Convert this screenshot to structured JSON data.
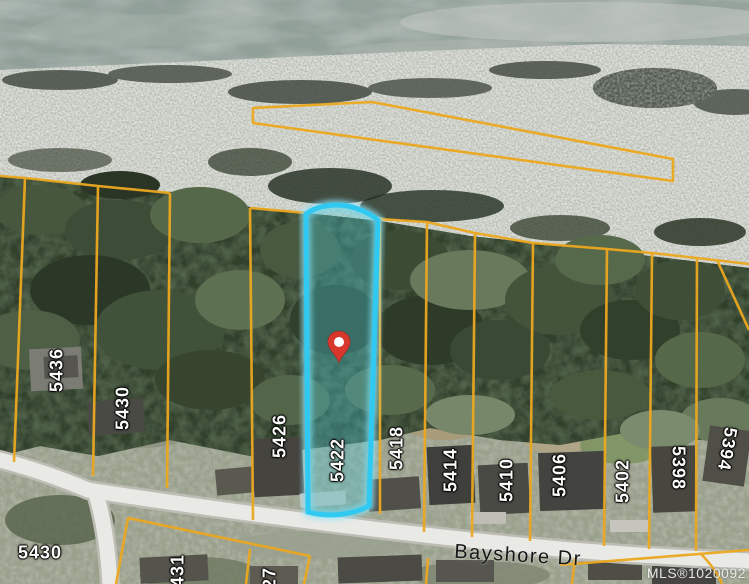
{
  "map": {
    "street": {
      "label": "Bayshore Dr"
    },
    "watermark": {
      "text": "MLS®1020092"
    },
    "highlighted_parcel": {
      "number": "5422",
      "border_color": "#2fc9f1",
      "fill_color": "rgba(70,200,215,0.34)",
      "marker_color": "#d8372b"
    },
    "colors": {
      "parcel_line": "#eca81f",
      "water": "#8e9d97",
      "beach_rock": "#b5bab1",
      "forest": "#31402c",
      "road": "#e9e9e5",
      "label_text": "#fbfbf9"
    },
    "parcel_labels": [
      {
        "text": "5436",
        "x": 57,
        "y": 370,
        "rot": -90
      },
      {
        "text": "5430",
        "x": 123,
        "y": 408,
        "rot": -90
      },
      {
        "text": "5426",
        "x": 280,
        "y": 436,
        "rot": -90
      },
      {
        "text": "5422",
        "x": 338,
        "y": 460,
        "rot": -90
      },
      {
        "text": "5418",
        "x": 397,
        "y": 448,
        "rot": -90
      },
      {
        "text": "5414",
        "x": 451,
        "y": 470,
        "rot": -90
      },
      {
        "text": "5410",
        "x": 507,
        "y": 480,
        "rot": -90
      },
      {
        "text": "5406",
        "x": 560,
        "y": 475,
        "rot": -90
      },
      {
        "text": "5402",
        "x": 623,
        "y": 481,
        "rot": -90
      },
      {
        "text": "5398",
        "x": 678,
        "y": 468,
        "rot": 90
      },
      {
        "text": "5394",
        "x": 727,
        "y": 449,
        "rot": 100
      },
      {
        "text": "5431",
        "x": 178,
        "y": 576,
        "rot": -90
      },
      {
        "text": "5427",
        "x": 270,
        "y": 589,
        "rot": -90
      },
      {
        "text": "5430",
        "x": 40,
        "y": 553,
        "rot": 0
      }
    ]
  }
}
